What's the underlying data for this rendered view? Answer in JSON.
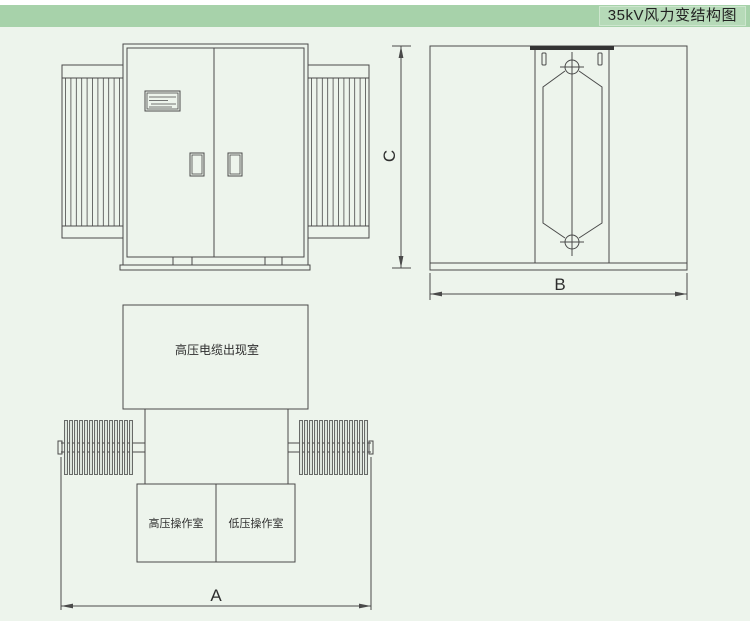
{
  "header": {
    "title": "35kV风力变结构图"
  },
  "side_view": {
    "height_dim_label": "C",
    "width_dim_label": "B"
  },
  "plan_view": {
    "cable_room_label": "高压电缆出现室",
    "hv_operation_room_label": "高压操作室",
    "lv_operation_room_label": "低压操作室",
    "width_dim_label": "A"
  },
  "colors": {
    "header_bg": "#a7d2aa",
    "title_badge_bg": "#b6dab8",
    "canvas_bg": "#edf4ec",
    "line": "#4a4a4a",
    "top_bar_fill": "#333333"
  }
}
